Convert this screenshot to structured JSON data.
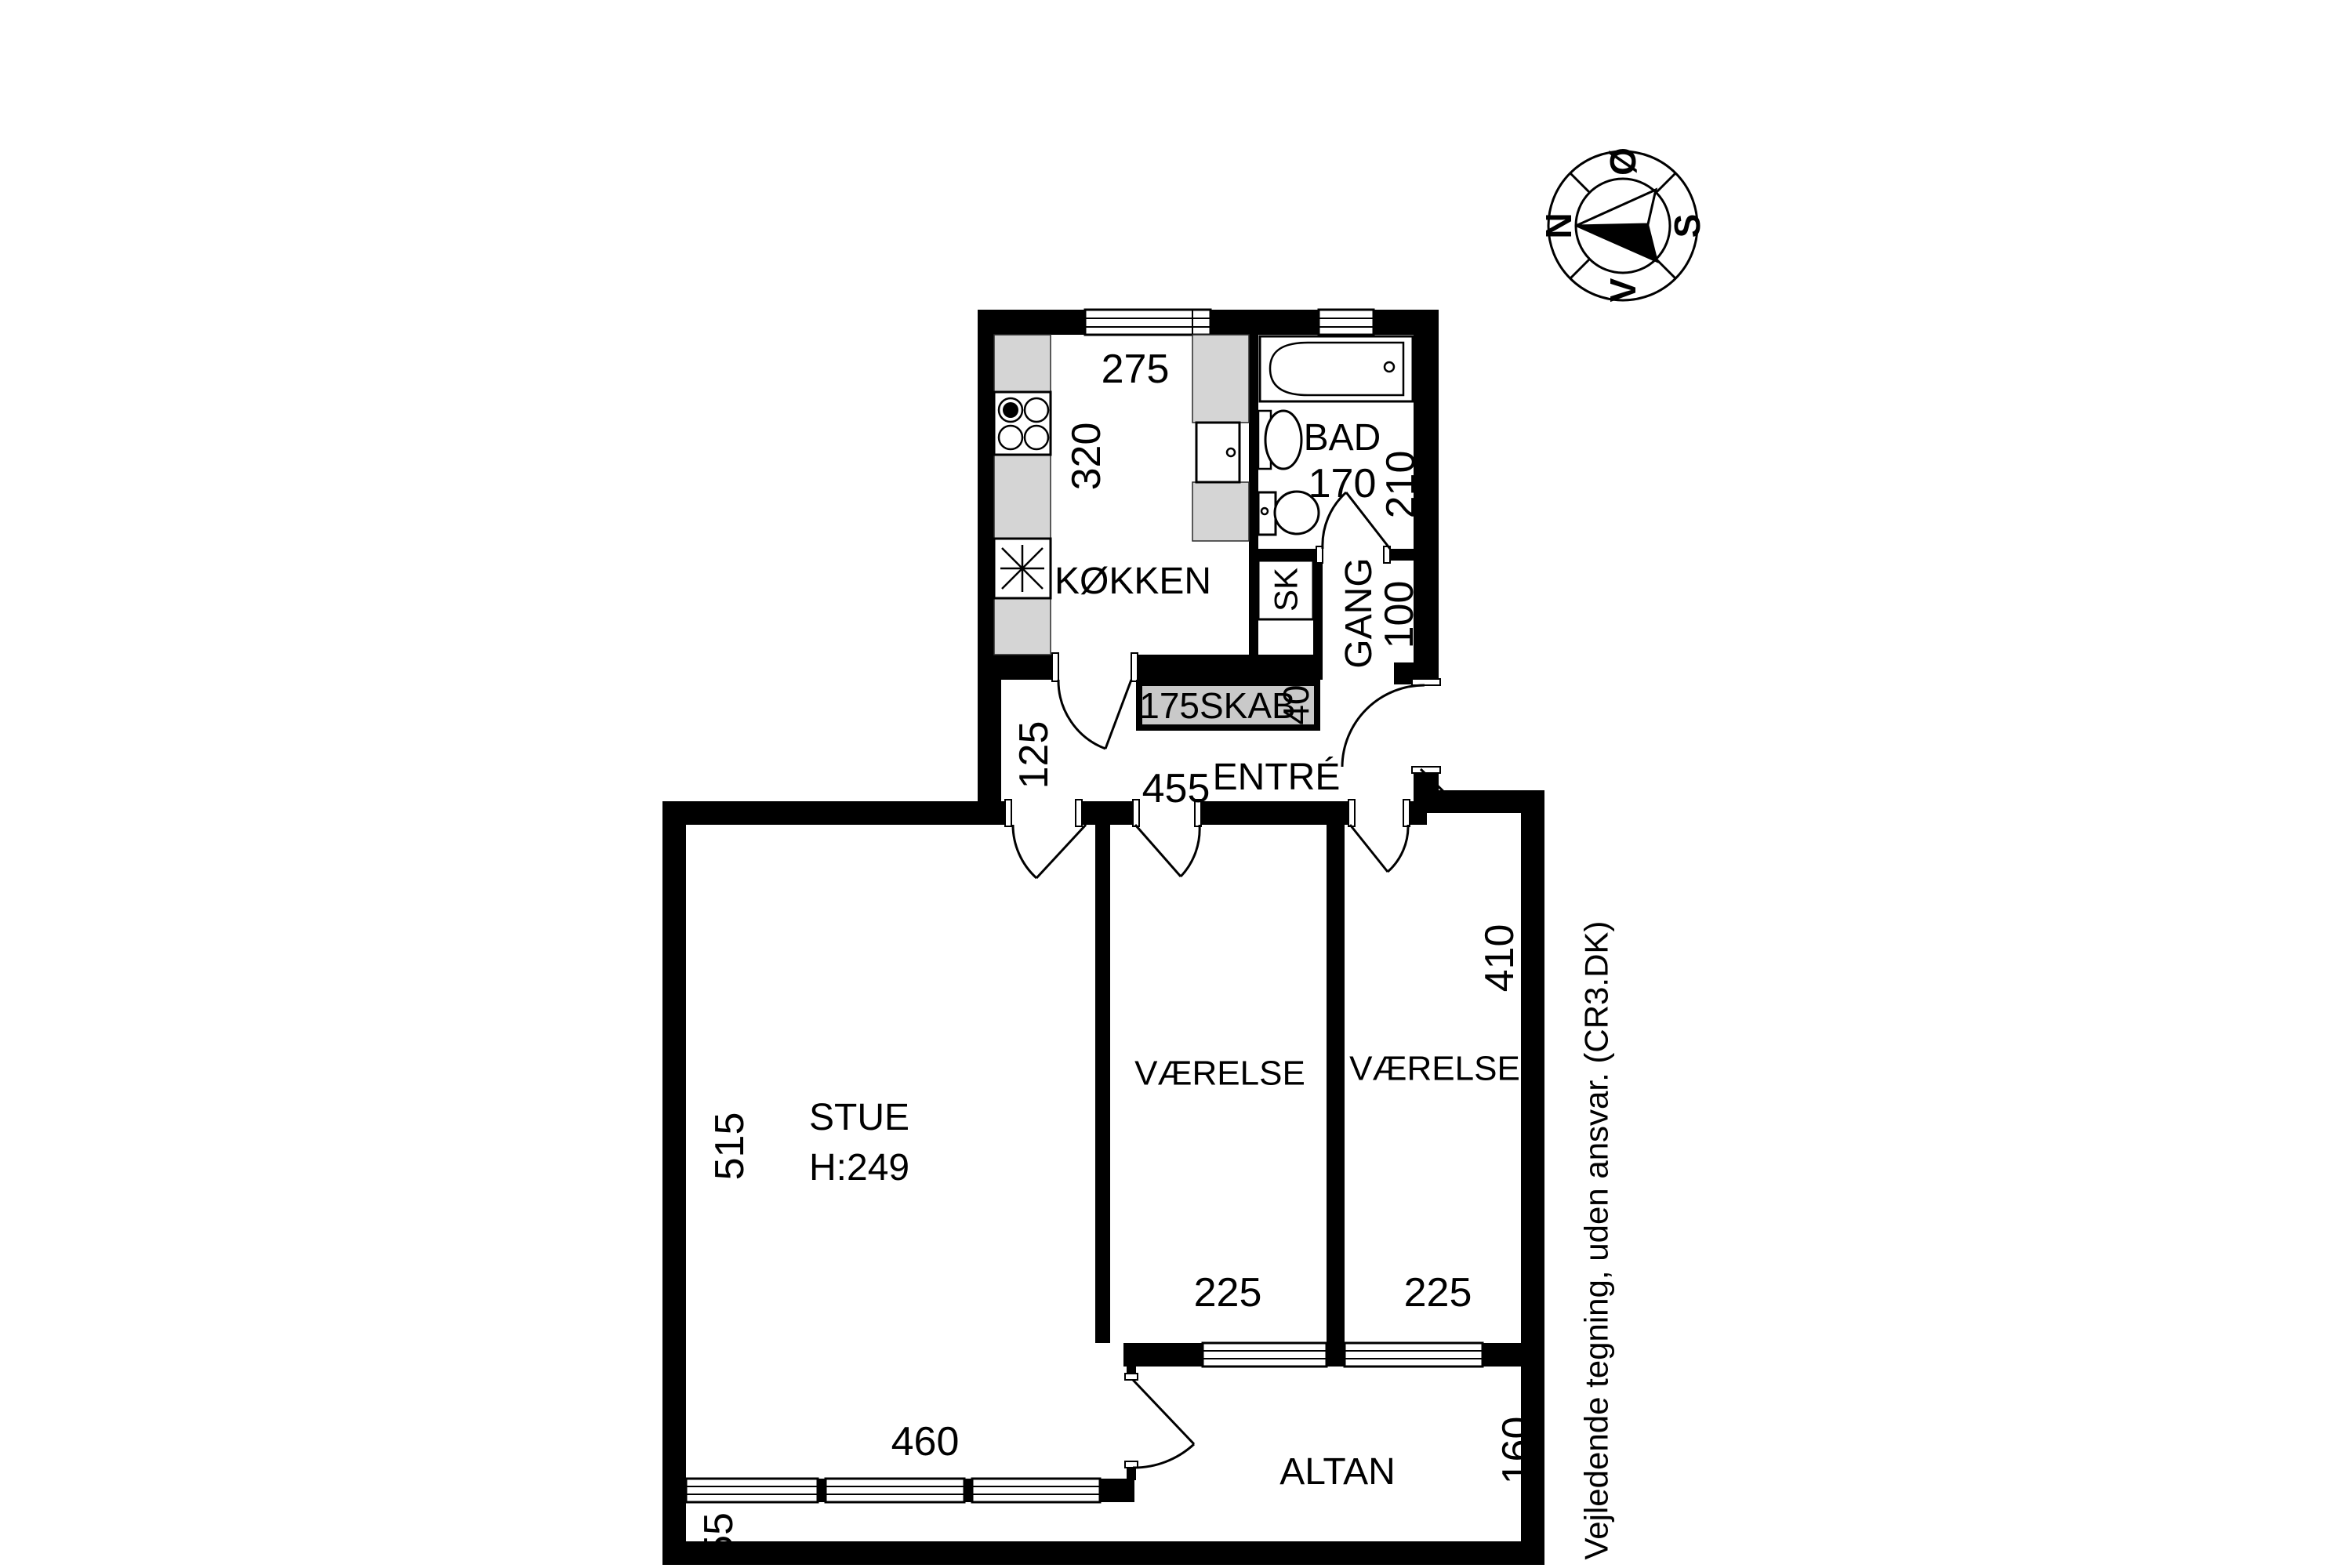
{
  "image": {
    "type": "apartment-floor-plan"
  },
  "compass": {
    "north": "N",
    "east": "Ø",
    "south": "S",
    "west": "V"
  },
  "disclaimer": "Vejledende tegning, uden ansvar. (CR3.DK)",
  "rooms": {
    "koekken": {
      "label": "KØKKEN",
      "width": "275",
      "depth": "320"
    },
    "bad": {
      "label": "BAD",
      "width": "170",
      "depth": "210"
    },
    "gang": {
      "label": "GANG",
      "width": "100"
    },
    "sk": {
      "label": "SK"
    },
    "skab": {
      "label": "175SKAB",
      "depth": "40"
    },
    "entre": {
      "label": "ENTRÉ",
      "width": "455",
      "left_depth": "125"
    },
    "stue": {
      "label": "STUE",
      "ceiling_height": "H:249",
      "width": "460",
      "depth": "515"
    },
    "vaerelse_left": {
      "label": "VÆRELSE",
      "width": "225"
    },
    "vaerelse_right": {
      "label": "VÆRELSE",
      "width": "225",
      "depth": "410"
    },
    "altan": {
      "label": "ALTAN",
      "depth": "160",
      "walkway_depth": "55"
    }
  },
  "colors": {
    "wall": "#000000",
    "counter_fill": "#d5d5d5",
    "skab_fill": "#c9c9c9",
    "background": "#ffffff"
  }
}
